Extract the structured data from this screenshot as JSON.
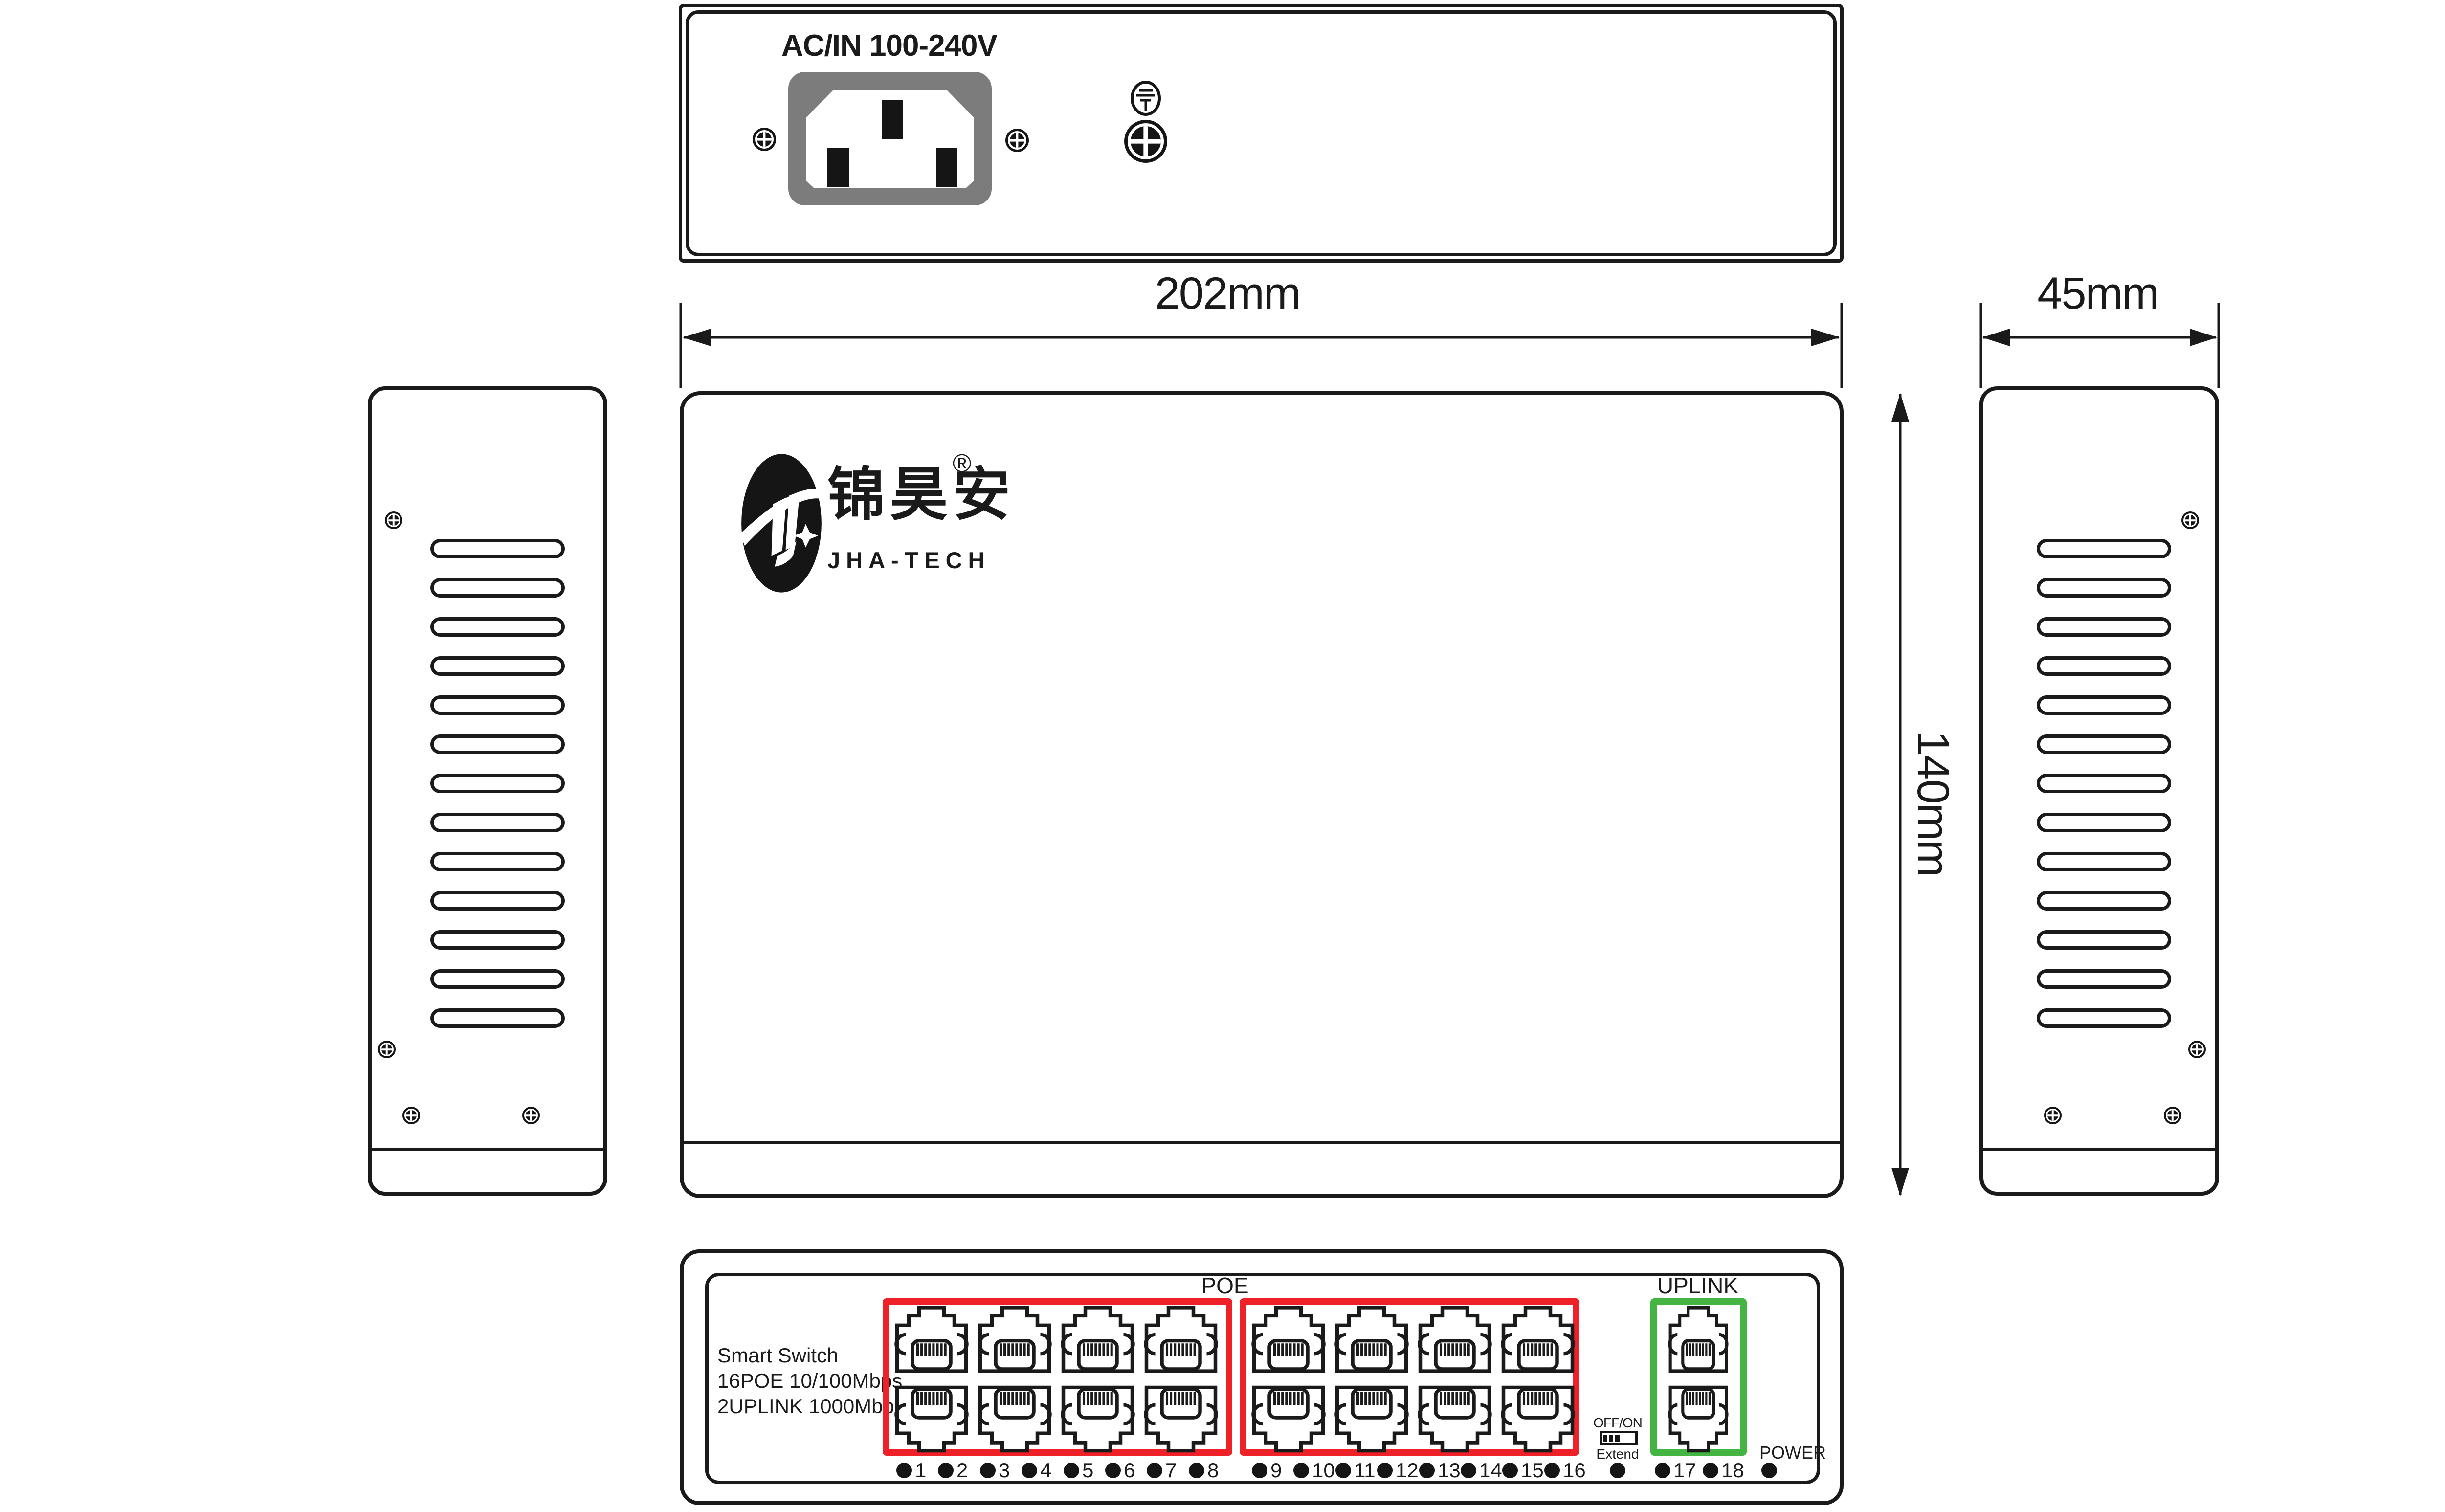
{
  "title": "PoE switch mechanical drawing",
  "colors": {
    "line": "#1a1a1a",
    "poe_group_border": "#ee2129",
    "uplink_group_border": "#44b543",
    "socket_gray": "#7c7c7c"
  },
  "dimensions": {
    "width_label": "202mm",
    "depth_label": "45mm",
    "height_label": "140mm"
  },
  "rear_view": {
    "power_label": "AC/IN 100-240V"
  },
  "top_view": {
    "logo_cn": "锦昊安",
    "logo_reg": "®",
    "logo_en": "JHA-TECH"
  },
  "front_view": {
    "info_lines": [
      "Smart Switch",
      "16POE 10/100Mbps",
      "2UPLINK 1000Mbps"
    ],
    "poe_label": "POE",
    "uplink_label": "UPLINK",
    "switch_top": "OFF/ON",
    "switch_bottom": "Extend",
    "power_label": "POWER",
    "poe1_leds": [
      "1",
      "2",
      "3",
      "4",
      "5",
      "6",
      "7",
      "8"
    ],
    "poe2_leds": [
      "9",
      "10",
      "11",
      "12",
      "13",
      "14",
      "15",
      "16"
    ],
    "uplink_leds": [
      "17",
      "18"
    ]
  }
}
